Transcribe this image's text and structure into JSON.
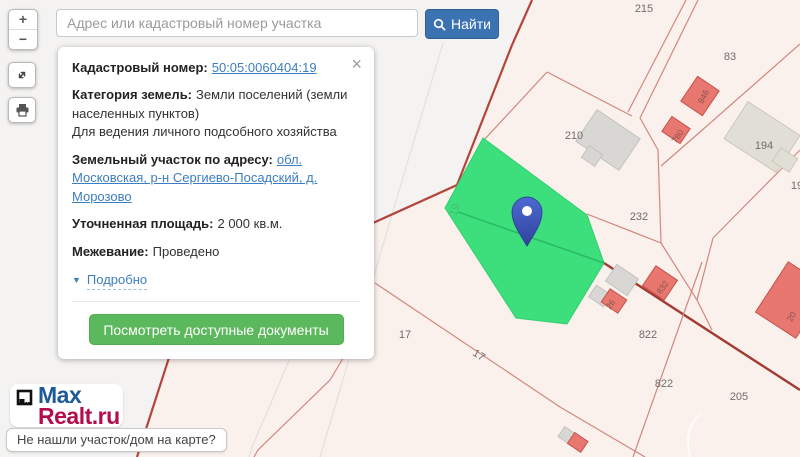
{
  "search": {
    "placeholder": "Адрес или кадастровый номер участка",
    "find_label": "Найти"
  },
  "map_controls": {
    "zoom_in": "+",
    "zoom_out": "−"
  },
  "card": {
    "cadastral_label": "Кадастровый номер:",
    "cadastral_number": "50:05:0060404:19",
    "category_label": "Категория земель:",
    "category_value": "Земли поселений (земли населенных пунктов)",
    "category_extra": "Для ведения личного подсобного хозяйства",
    "address_label": "Земельный участок по адресу:",
    "address_value": "обл. Московская, р-н Сергиево-Посадский, д. Морозово",
    "area_label": "Уточненная площадь:",
    "area_value": "2 000 кв.м.",
    "survey_label": "Межевание:",
    "survey_value": "Проведено",
    "details_label": "Подробно",
    "documents_button": "Посмотреть доступные документы",
    "close_label": "×"
  },
  "logo": {
    "line1": "Max",
    "line2": "Realt.ru"
  },
  "footer": {
    "not_found_label": "Не нашли участок/дом на карте?"
  },
  "map": {
    "colors": {
      "accent_blue": "#3a72b2",
      "link_blue": "#3d7dc1",
      "button_green": "#5cb85c",
      "selected_parcel_green": "#3cdf7b",
      "quarter_fill": "#faf0ec",
      "outside_fill": "#f4f3f1",
      "parcel_line": "#d0887f",
      "quarter_boundary": "#b4453c",
      "road": "#a23a31",
      "building_red": "#e7776f",
      "building_gray": "#d8d7d3",
      "pin_blue": "#4061c6"
    },
    "labels": [
      {
        "text": "215",
        "x": 644,
        "y": 12
      },
      {
        "text": "83",
        "x": 730,
        "y": 60
      },
      {
        "text": "210",
        "x": 574,
        "y": 139
      },
      {
        "text": "194",
        "x": 764,
        "y": 149
      },
      {
        "text": "232",
        "x": 639,
        "y": 220
      },
      {
        "text": "822",
        "x": 648,
        "y": 338
      },
      {
        "text": "822",
        "x": 664,
        "y": 387
      },
      {
        "text": "205",
        "x": 739,
        "y": 400
      },
      {
        "text": "17",
        "x": 405,
        "y": 338
      },
      {
        "text": "17",
        "x": 477,
        "y": 358,
        "rot": 33
      },
      {
        "text": "19",
        "x": 797,
        "y": 189
      },
      {
        "text": "19",
        "x": 458,
        "y": 211,
        "rot": -70,
        "opacity": 0.3
      }
    ],
    "building_labels": [
      {
        "text": "846",
        "x": 706,
        "y": 98,
        "rot": -62
      },
      {
        "text": "780",
        "x": 680,
        "y": 138,
        "rot": -55
      },
      {
        "text": "832",
        "x": 665,
        "y": 289,
        "rot": -55
      },
      {
        "text": "26",
        "x": 613,
        "y": 306,
        "rot": -55
      },
      {
        "text": "20",
        "x": 794,
        "y": 318,
        "rot": -60
      }
    ]
  }
}
